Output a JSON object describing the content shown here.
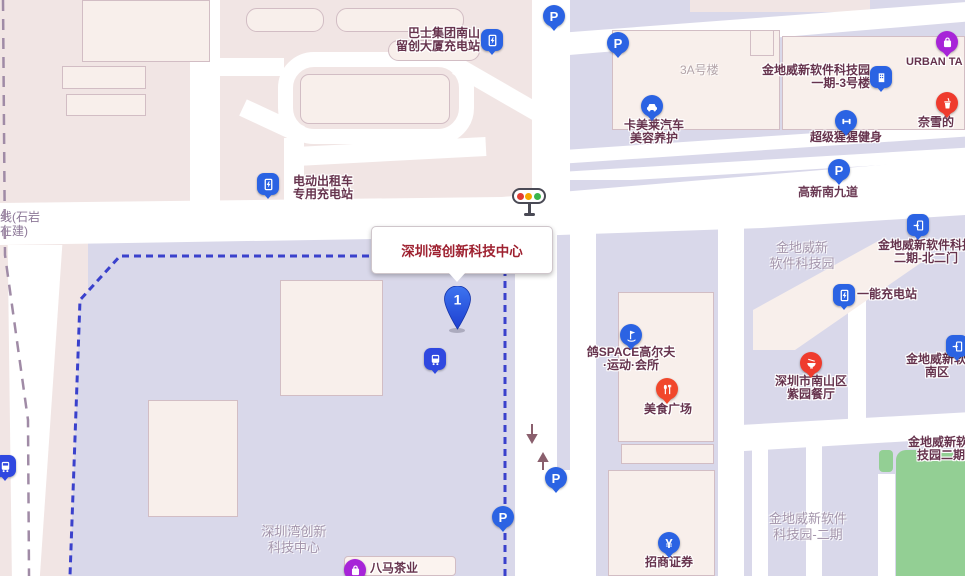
{
  "callout": {
    "title": "深圳湾创新科技中心",
    "marker_number": "1"
  },
  "icons": {
    "parking_glyph": "P",
    "yuan_glyph": "¥"
  },
  "road_labels": {
    "gaoxin_south_9": "高新南九道"
  },
  "metro_label": {
    "line1": "线(石岩",
    "line2": "在建)"
  },
  "area_labels": {
    "building_3a": "3A号楼",
    "jindi_park_line1": "金地威新",
    "jindi_park_line2": "软件科技园",
    "jindi_phase2_line1": "金地威新软件",
    "jindi_phase2_line2": "科技园-二期",
    "szbay_line1": "深圳湾创新",
    "szbay_line2": "科技中心"
  },
  "pois": {
    "bus_depot_charging": {
      "line1": "巴士集团南山",
      "line2": "留创大厦充电站"
    },
    "ev_taxi_charging": {
      "line1": "电动出租车",
      "line2": "专用充电站"
    },
    "urban_tag": {
      "label": "URBAN TA"
    },
    "camellia_car": {
      "line1": "卡美莱汽车",
      "line2": "美容养护"
    },
    "jindi_phase1_bldg3": {
      "line1": "金地威新软件科技园",
      "line2": "一期-3号楼"
    },
    "supermonkey_gym": {
      "label": "超级猩猩健身"
    },
    "naixue_tea": {
      "label": "奈雪的"
    },
    "golf_club": {
      "line1": "鸽SPACE高尔夫",
      "line2": "·运动·会所"
    },
    "food_plaza": {
      "label": "美食广场"
    },
    "north_gate2": {
      "line1": "金地威新软件科技",
      "line2": "二期-北二门"
    },
    "yineng_charging": {
      "label": "一能充电站"
    },
    "ziyuan_restaurant": {
      "line1": "深圳市南山区",
      "line2": "紫园餐厅"
    },
    "south_area": {
      "line1": "金地威新软",
      "line2": "南区"
    },
    "jindi_phase2_poi": {
      "line1": "金地威新软",
      "line2": "技园二期"
    },
    "cmb_securities": {
      "label": "招商证券"
    },
    "bama_tea": {
      "label": "八马茶业"
    }
  },
  "colors": {
    "poi_blue": "#2b63e3",
    "poi_red": "#f1472b",
    "poi_purple": "#a724d8",
    "block_lavender": "#d9d8ea",
    "block_pink": "#f1e5e4",
    "building_fill": "#f8efeb",
    "green_area": "#93cf94",
    "parcel_border_blue": "#3a41cc",
    "metro_line_gray": "#a08ba6",
    "callout_title_color": "#9e2130",
    "poi_label_color": "#66334d",
    "area_label_color": "#a495ab",
    "traffic_red": "#e23c32",
    "traffic_amber": "#f5a700",
    "traffic_green": "#3bb54b"
  }
}
